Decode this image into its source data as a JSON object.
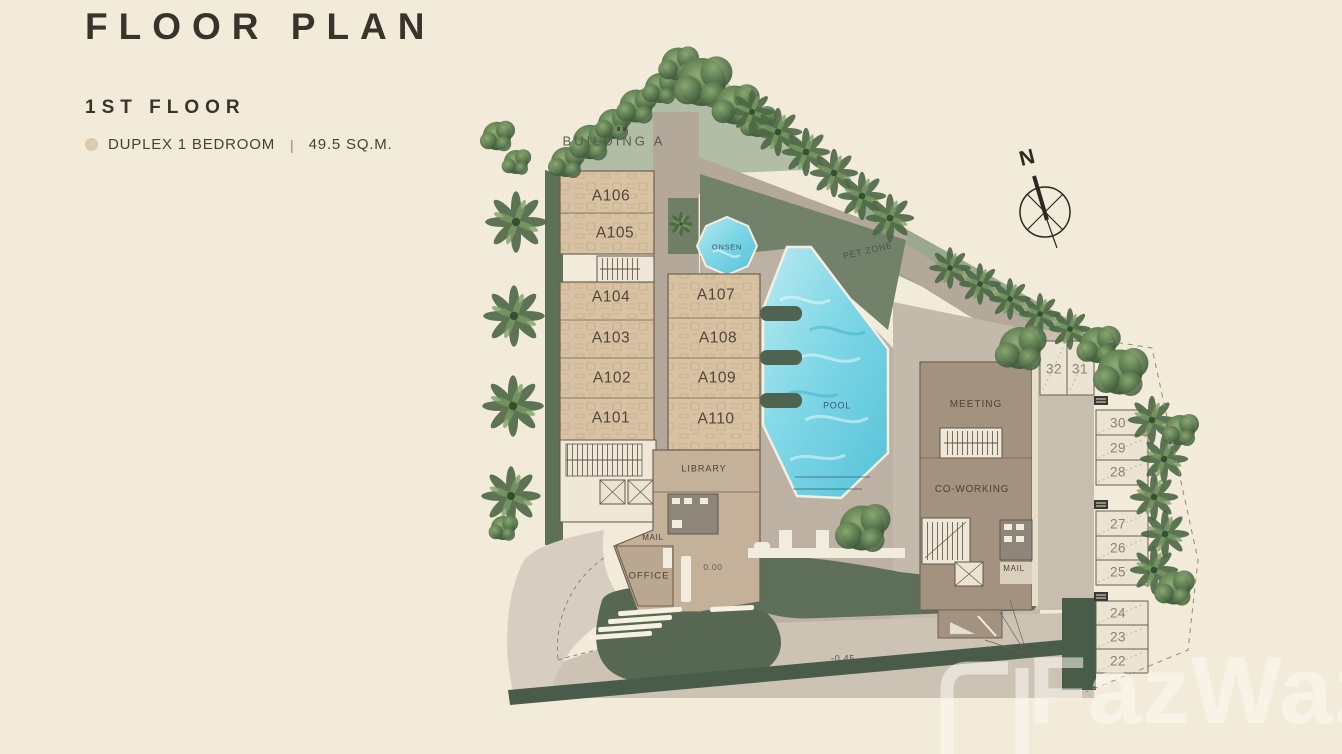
{
  "header": {
    "title": "FLOOR PLAN",
    "floor": "1ST FLOOR"
  },
  "legend": {
    "unit_type": "DUPLEX 1 BEDROOM",
    "separator": "|",
    "area": "49.5 SQ.M.",
    "swatch_color": "#d9cab1"
  },
  "plan": {
    "building_label": "BUILDING A",
    "compass": "N",
    "cd_mark": "CD",
    "units": [
      {
        "label": "A106"
      },
      {
        "label": "A105"
      },
      {
        "label": "A104"
      },
      {
        "label": "A103"
      },
      {
        "label": "A102"
      },
      {
        "label": "A101"
      },
      {
        "label": "A107"
      },
      {
        "label": "A108"
      },
      {
        "label": "A109"
      },
      {
        "label": "A110"
      }
    ],
    "amenities": {
      "onsen": "ONSEN",
      "pool": "POOL",
      "pet_zone": "PET ZONE",
      "meeting": "MEETING",
      "coworking": "CO-WORKING",
      "library": "LIBRARY",
      "mail_lobby": "MAIL",
      "office": "OFFICE",
      "mail_club": "MAIL"
    },
    "levels": {
      "lobby": "0.00",
      "road_west": "-0.45",
      "road_east": "-0.25"
    },
    "parking": [
      "32",
      "31",
      "30",
      "29",
      "28",
      "27",
      "26",
      "25",
      "24",
      "23",
      "22"
    ],
    "colors": {
      "background": "#f3ebd9",
      "landscape": "#72826a",
      "landscape_light": "#b2bda6",
      "paving": "#b9aea0",
      "building_tan": "#d8c2a2",
      "clubhouse": "#a3927f",
      "pool_blue": "#7fd7e6",
      "boundary_strip": "#495c49"
    }
  },
  "watermark": {
    "text": "FazWaz"
  }
}
